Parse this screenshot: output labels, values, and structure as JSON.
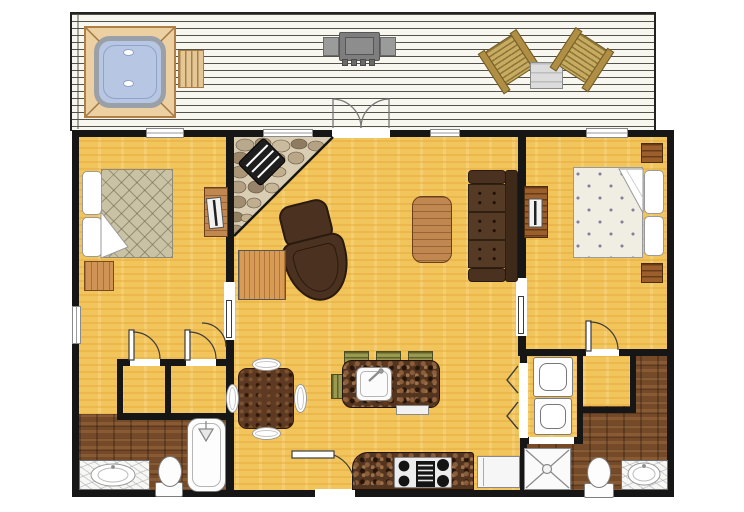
{
  "title": "Two-bedroom cabin floor plan with rear deck",
  "colors": {
    "wall": "#161616",
    "main_floor": "#f2c45c",
    "bath_floor": "#744a28",
    "deck": "#f7f6ef",
    "granite_counter": "#53341f",
    "upholstery_brown": "#4a3120",
    "wood_furniture": "#c08850",
    "hot_tub_water": "#b7c6e2",
    "hot_tub_frame": "#ecd0a2",
    "stool_green": "#99994f",
    "bedspread_left": "#c9c2a4",
    "bedspread_right": "#f0eee3",
    "fireplace_stone": "#b9a98c",
    "grill_gray": "#7e7e7e",
    "marble": "#f7f7f4"
  },
  "legend": {
    "deck_items": [
      "hot-tub",
      "bench",
      "bbq-grill",
      "adirondack-chair",
      "patio-table",
      "adirondack-chair",
      "french-doors"
    ],
    "living_room_items": [
      "corner-stone-fireplace",
      "ottoman",
      "armchair",
      "side-table",
      "coffee-table",
      "three-seat-sofa"
    ],
    "kitchen_items": [
      "dining-table-with-plates",
      "island-with-sink",
      "bar-stools",
      "range-stove",
      "refrigerator",
      "dishwasher-drawer",
      "entry-door"
    ],
    "bedroom_left_items": [
      "double-bed",
      "nightstand",
      "dresser-with-tv",
      "two-closets",
      "pocket-door",
      "window"
    ],
    "bedroom_right_items": [
      "double-bed",
      "two-nightstands",
      "dresser-with-tv",
      "closet",
      "pocket-door",
      "window"
    ],
    "bathroom_left_items": [
      "marble-vanity-sink",
      "toilet",
      "bathtub-shower"
    ],
    "bathroom_right_items": [
      "stacked-washer-dryer",
      "bifold-doors",
      "shower-stall",
      "toilet",
      "marble-vanity-sink"
    ]
  }
}
